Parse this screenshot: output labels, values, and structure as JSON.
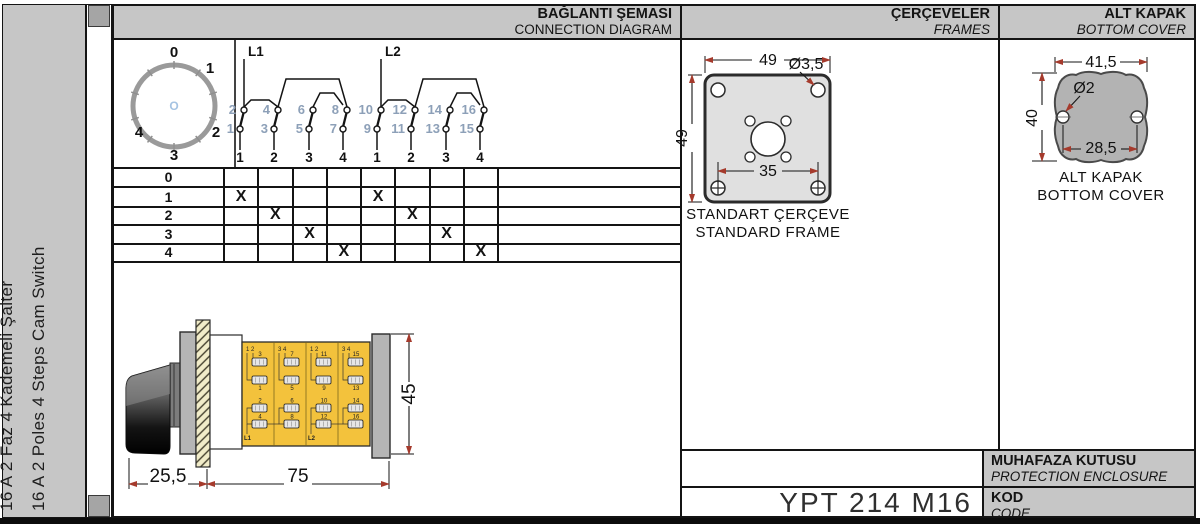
{
  "sidebar": {
    "title_tr": "16 A 2 Faz 4 Kademeli Şalter",
    "title_en": "16 A 2 Poles 4 Steps Cam Switch"
  },
  "sections": {
    "connection": {
      "title_tr": "BAĞLANTI ŞEMASI",
      "title_en": "CONNECTION DIAGRAM"
    },
    "frames": {
      "title_tr": "ÇERÇEVELER",
      "title_en": "FRAMES"
    },
    "bottom_cover": {
      "title_tr": "ALT KAPAK",
      "title_en": "BOTTOM COVER"
    },
    "side": {
      "title_tr": "YANDAN GÖRÜNÜŞ",
      "title_en": "SIDE"
    },
    "enclosure": {
      "title_tr": "MUHAFAZA KUTUSU",
      "title_en": "PROTECTION ENCLOSURE"
    },
    "code": {
      "title_tr": "KOD",
      "title_en": "CODE",
      "value": "YPT 214 M16"
    }
  },
  "dial": {
    "positions": [
      "0",
      "1",
      "2",
      "3",
      "4"
    ],
    "center_mark": "O"
  },
  "switch_groups": [
    {
      "feed": "L1",
      "top_terminals": [
        "2",
        "4",
        "6",
        "8"
      ],
      "bottom_terminals": [
        "1",
        "3",
        "5",
        "7"
      ],
      "column_labels": [
        "1",
        "2",
        "3",
        "4"
      ]
    },
    {
      "feed": "L2",
      "top_terminals": [
        "10",
        "12",
        "14",
        "16"
      ],
      "bottom_terminals": [
        "9",
        "11",
        "13",
        "15"
      ],
      "column_labels": [
        "1",
        "2",
        "3",
        "4"
      ]
    }
  ],
  "position_table": {
    "mark": "X",
    "rows": [
      {
        "label": "0",
        "cells": [
          "",
          "",
          "",
          "",
          "",
          "",
          "",
          ""
        ]
      },
      {
        "label": "1",
        "cells": [
          "X",
          "",
          "",
          "",
          "X",
          "",
          "",
          ""
        ]
      },
      {
        "label": "2",
        "cells": [
          "",
          "X",
          "",
          "",
          "",
          "X",
          "",
          ""
        ]
      },
      {
        "label": "3",
        "cells": [
          "",
          "",
          "X",
          "",
          "",
          "",
          "X",
          ""
        ]
      },
      {
        "label": "4",
        "cells": [
          "",
          "",
          "",
          "X",
          "",
          "",
          "",
          "X"
        ]
      }
    ]
  },
  "frames_drawing": {
    "dim_width": "49",
    "dim_height": "49",
    "dim_hole": "Ø3,5",
    "dim_holes_span": "35",
    "caption_tr": "STANDART ÇERÇEVE",
    "caption_en": "STANDARD FRAME"
  },
  "cover_drawing": {
    "dim_width": "41,5",
    "dim_height": "40",
    "dim_hole": "Ø2",
    "dim_holes_span": "28,5",
    "caption_tr": "ALT KAPAK",
    "caption_en": "BOTTOM COVER"
  },
  "side_view": {
    "dim_knob": "25,5",
    "dim_body": "75",
    "dim_height": "45",
    "modules": [
      {
        "corner": "1 2",
        "top": [
          "3",
          "1"
        ],
        "bottom": [
          "2",
          "4"
        ],
        "feed": "L1"
      },
      {
        "corner": "3 4",
        "top": [
          "7",
          "5"
        ],
        "bottom": [
          "6",
          "8"
        ],
        "feed": ""
      },
      {
        "corner": "1 2",
        "top": [
          "11",
          "9"
        ],
        "bottom": [
          "10",
          "12"
        ],
        "feed": "L2"
      },
      {
        "corner": "3 4",
        "top": [
          "15",
          "13"
        ],
        "bottom": [
          "14",
          "16"
        ],
        "feed": ""
      }
    ]
  },
  "colors": {
    "band_gray": "#c6c6c6",
    "line_black": "#141414",
    "terminal_blue": "#8da0b8",
    "dim_red": "#a53a2c",
    "body_yellow": "#f3c23c",
    "hatch_cream": "#f1ecc9",
    "plate_gray": "#b5b5b5",
    "frame_fill": "#e0e0e0",
    "cover_fill": "#b3b3b3"
  }
}
